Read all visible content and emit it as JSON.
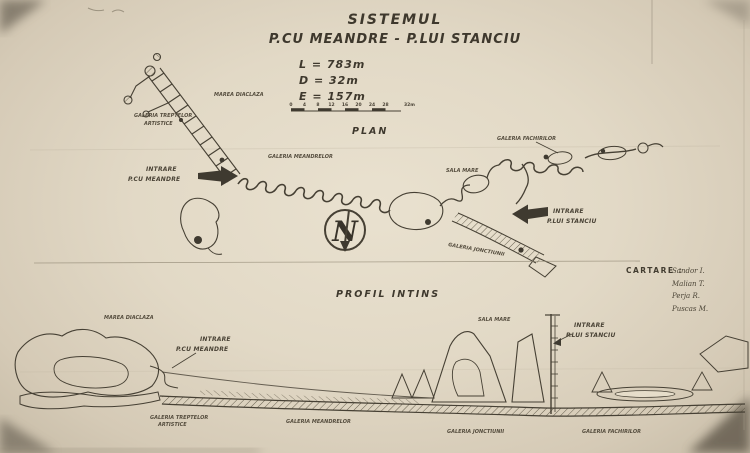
{
  "colors": {
    "paper": "#e2d9c6",
    "ink": "#3f3a30"
  },
  "title": {
    "line1": "SISTEMUL",
    "line2": "P.CU MEANDRE - P.LUI STANCIU"
  },
  "stats": {
    "length": "L = 783m",
    "depth": "D = 32m",
    "extension": "E = 157m"
  },
  "scalebar": {
    "ticks": [
      "0",
      "4",
      "8",
      "12",
      "16",
      "20",
      "24",
      "28"
    ],
    "end_label": "32m"
  },
  "plan": {
    "heading": "PLAN",
    "north_letter": "N",
    "labels": {
      "marea_diaclaza": "MAREA DIACLAZA",
      "galeria_treptelor_1": "GALERIA TREPTELOR",
      "galeria_treptelor_2": "ARTISTICE",
      "intrare_meandre_1": "INTRARE",
      "intrare_meandre_2": "P.CU MEANDRE",
      "galeria_meandrelor": "GALERIA MEANDRELOR",
      "sala_mare": "SALA MARE",
      "galeria_fachirilor": "GALERIA FACHIRILOR",
      "intrare_stanciu_1": "INTRARE",
      "intrare_stanciu_2": "P.LUI STANCIU",
      "galeria_jonctiunii": "GALERIA JONCTIUNII"
    }
  },
  "profile": {
    "heading": "PROFIL INTINS",
    "labels": {
      "marea_diaclaza": "MAREA DIACLAZA",
      "intrare_meandre_1": "INTRARE",
      "intrare_meandre_2": "P.CU MEANDRE",
      "galeria_treptelor_1": "GALERIA TREPTELOR",
      "galeria_treptelor_2": "ARTISTICE",
      "galeria_meandrelor": "GALERIA MEANDRELOR",
      "sala_mare": "SALA MARE",
      "intrare_stanciu_1": "INTRARE",
      "intrare_stanciu_2": "P.LUI STANCIU",
      "galeria_jonctiunii": "GALERIA JONCTIUNII",
      "galeria_fachirilor": "GALERIA FACHIRILOR"
    }
  },
  "credits": {
    "heading": "CARTARE :",
    "names": [
      "Sandor I.",
      "Malian T.",
      "Perja R.",
      "Puscas M."
    ]
  }
}
